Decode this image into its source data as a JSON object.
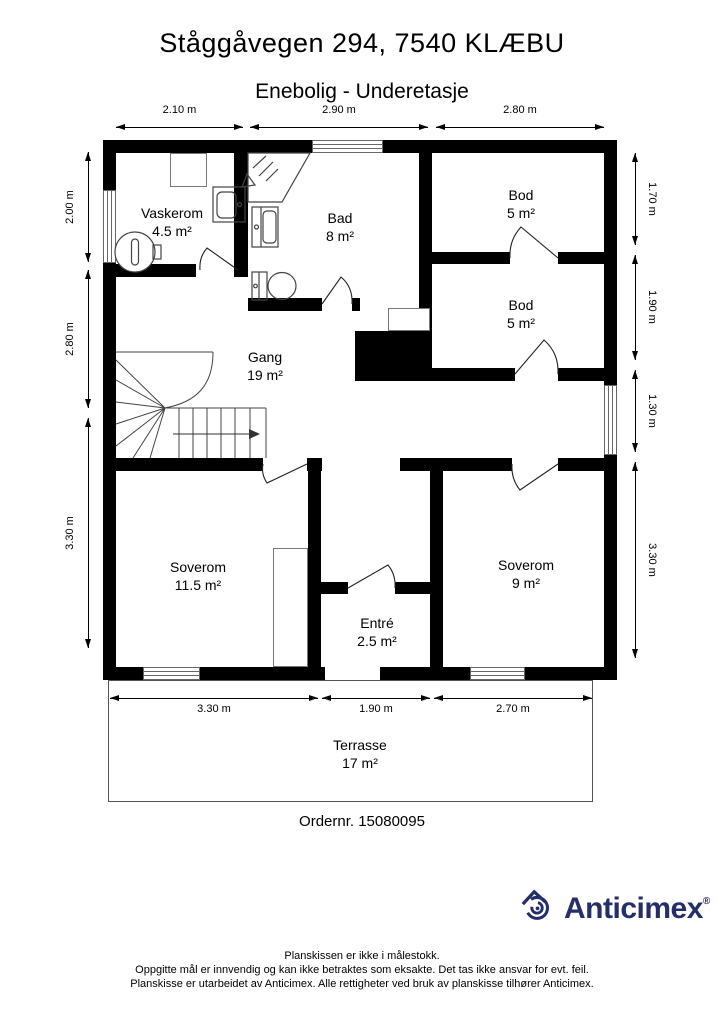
{
  "header": {
    "title": "Ståggåvegen 294, 7540 KLÆBU",
    "subtitle": "Enebolig - Underetasje"
  },
  "rooms": [
    {
      "name": "Vaskerom",
      "area": "4.5 m²"
    },
    {
      "name": "Bad",
      "area": "8 m²"
    },
    {
      "name": "Bod",
      "area": "5 m²"
    },
    {
      "name": "Bod",
      "area": "5 m²"
    },
    {
      "name": "Gang",
      "area": "19 m²"
    },
    {
      "name": "Soverom",
      "area": "11.5 m²"
    },
    {
      "name": "Entré",
      "area": "2.5 m²"
    },
    {
      "name": "Soverom",
      "area": "9 m²"
    },
    {
      "name": "Terrasse",
      "area": "17 m²"
    }
  ],
  "dimensions": {
    "top": [
      "2.10 m",
      "2.90 m",
      "2.80 m"
    ],
    "left": [
      "2.00 m",
      "2.80 m",
      "3.30 m"
    ],
    "right": [
      "1.70 m",
      "1.90 m",
      "1.30 m",
      "3.30 m"
    ],
    "bottom": [
      "3.30 m",
      "1.90 m",
      "2.70 m"
    ]
  },
  "order_number": "Ordernr. 15080095",
  "logo": {
    "text": "Anticimex",
    "registered": "®",
    "color": "#232e6a"
  },
  "footer": [
    "Planskissen er ikke i målestokk.",
    "Oppgitte mål er innvendig og kan ikke betraktes som eksakte. Det tas ikke ansvar for evt. feil.",
    "Planskisse er utarbeidet av Anticimex. Alle rettigheter ved bruk av planskisse tilhører Anticimex."
  ]
}
